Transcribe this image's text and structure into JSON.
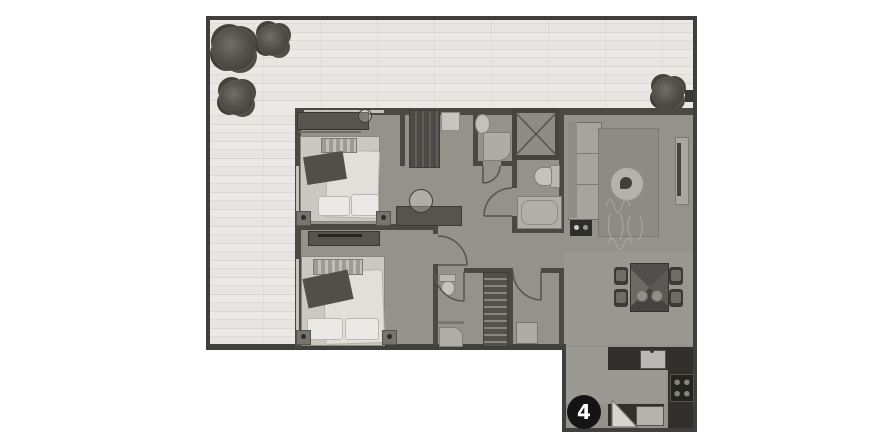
{
  "floorplan": {
    "unit_badge": "4",
    "colors": {
      "wall": "#403f3b",
      "terrace_wood": "#e9e7e3",
      "interior_floor": "#93928b",
      "kitchen_counter": "#31302d",
      "badge_background": "#141414",
      "badge_text": "#ffffff"
    },
    "icons": [
      "tree-icon",
      "tree-icon",
      "tree-icon",
      "tree-icon",
      "unit-number-badge",
      "shaft-cross-icon"
    ]
  }
}
